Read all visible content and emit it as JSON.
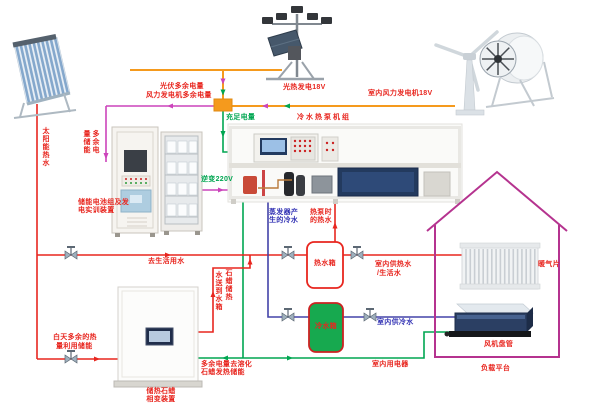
{
  "colors": {
    "pipe_hot": "#e8261f",
    "pipe_cold": "#4343a8",
    "wire_surplus": "#cc44bb",
    "wire_supply": "#00a651",
    "wire_generation": "#f59a1d",
    "house_outline": "#b5338f",
    "cold_tank_fill": "#17a94f"
  },
  "generation": {
    "pv_label": "光热发电18V",
    "wind_label": "室内风力发电机18V",
    "sufficient": "充足电量",
    "pv_surplus": "光伏多余电量",
    "wind_surplus": "风力发电机多余电量",
    "surplus_store": "多余电量储能",
    "inverter": "逆变220V",
    "appliances": "室内用电器",
    "melt_l1": "多余电量去溶化",
    "melt_l2": "石蜡发热储能"
  },
  "thermal": {
    "solar_hot_water": "太阳能热水",
    "to_domestic": "去生活用水",
    "day_surplus_l1": "白天多余的热",
    "day_surplus_l2": "量利用储能",
    "paraffin_send_r": "石蜡储热",
    "paraffin_send_l": "水送到水箱",
    "evap_l1": "蒸发器产",
    "evap_l2": "生的冷水",
    "hp_hot_l1": "热泵时",
    "hp_hot_l2": "的热水",
    "indoor_hot_l1": "室内供热水",
    "indoor_hot_l2": "/生活水",
    "indoor_cold": "室内供冷水"
  },
  "devices": {
    "heat_pump_title": "冷水热泵机组",
    "battery_l1": "储能电池组及发",
    "battery_l2": "电实训装置",
    "paraffin_l1": "储热石蜡",
    "paraffin_l2": "相变装置",
    "hot_tank": "热水箱",
    "cold_tank": "冷水箱",
    "radiator": "暖气片",
    "fan_coil": "风机盘管",
    "load_platform": "负载平台"
  }
}
